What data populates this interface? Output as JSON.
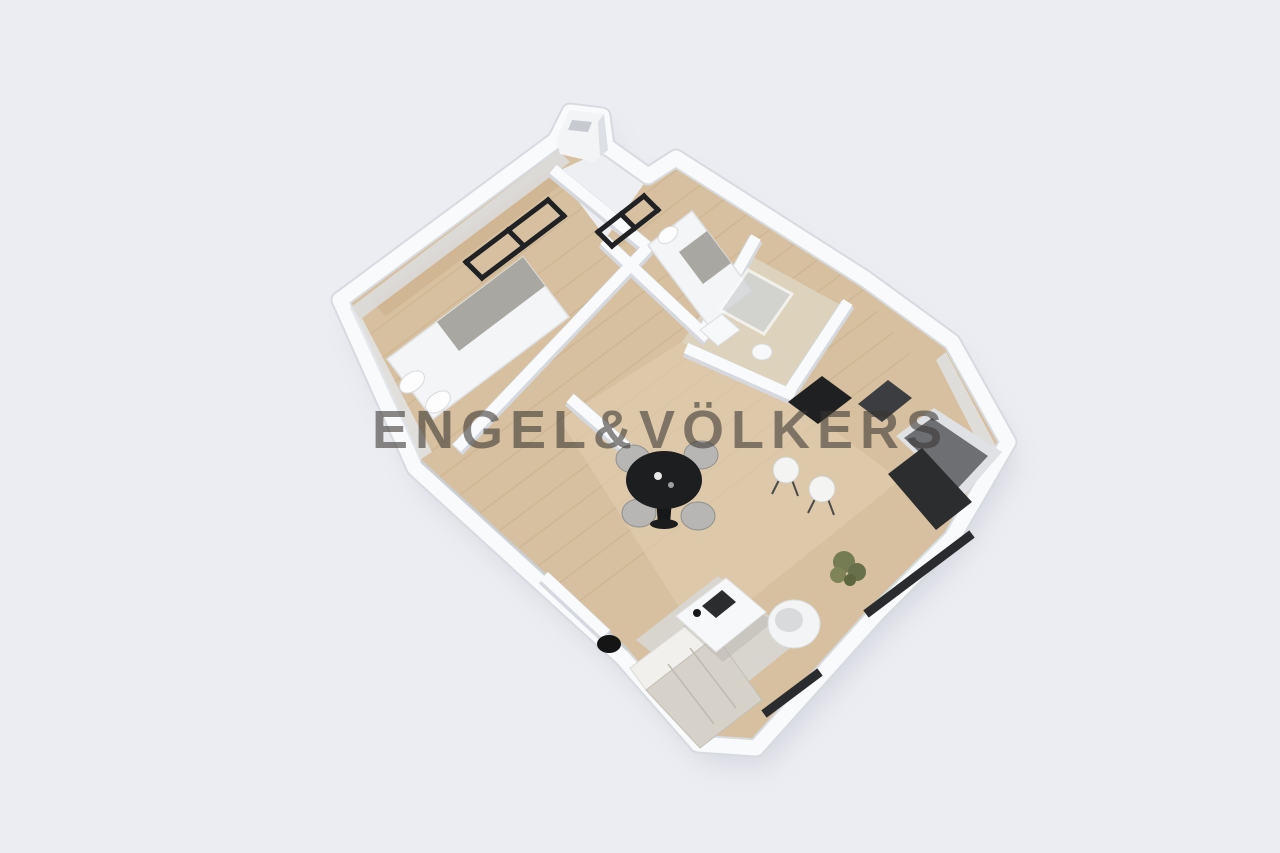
{
  "watermark": {
    "text": "ENGEL&VÖLKERS",
    "color": "#3a3632",
    "opacity": 0.58
  },
  "scene": {
    "type": "3d-floor-plan-render",
    "view": "isometric top-down, plan rotated about 37 degrees",
    "background_color": "#ecedf2",
    "palette": {
      "walls": "#f8fafc",
      "wall_rim": "#d7dade",
      "wall_shadow": "#dde0e5",
      "floor_wood": "#d6c09f",
      "floor_wood_light": "#e3d2b6",
      "plank_line": "#c5a87f",
      "window_frame": "#202124",
      "kitchen_dark": "#1f2022",
      "dining_table_black": "#1d1e20",
      "furniture_gray": "#b7b6b4",
      "bed_white": "#f4f5f6",
      "blanket_gray": "#a9a7a2",
      "rug_gray": "#d8d6d2",
      "sofa_beige": "#d6d2ca",
      "plant_green": "#757b52",
      "shadow": "#b8bcc8"
    },
    "rooms": [
      {
        "name": "master-bedroom",
        "position": "upper-left",
        "furniture": [
          "double-bed",
          "wardrobe-strip"
        ],
        "windows": 1
      },
      {
        "name": "second-bedroom",
        "position": "upper-right",
        "furniture": [
          "single-bed"
        ],
        "windows": 1
      },
      {
        "name": "bathroom",
        "position": "right-of-second-bedroom",
        "furniture": [
          "shower",
          "sink",
          "toilet"
        ]
      },
      {
        "name": "kitchen",
        "position": "right",
        "furniture": [
          "range",
          "dark-appliance",
          "counter",
          "fridge"
        ]
      },
      {
        "name": "living-dining-room",
        "position": "center-bottom",
        "furniture": [
          "round-black-dining-table",
          "four-gray-chairs",
          "two-white-stools",
          "gray-rug",
          "white-coffee-table",
          "sofa",
          "white-armchair",
          "tv-unit",
          "potted-plant"
        ]
      },
      {
        "name": "hallway",
        "position": "center"
      }
    ],
    "features": [
      "chimney-at-top",
      "black-framed-windows-top-walls",
      "dark-window-bands-bottom-right"
    ]
  }
}
